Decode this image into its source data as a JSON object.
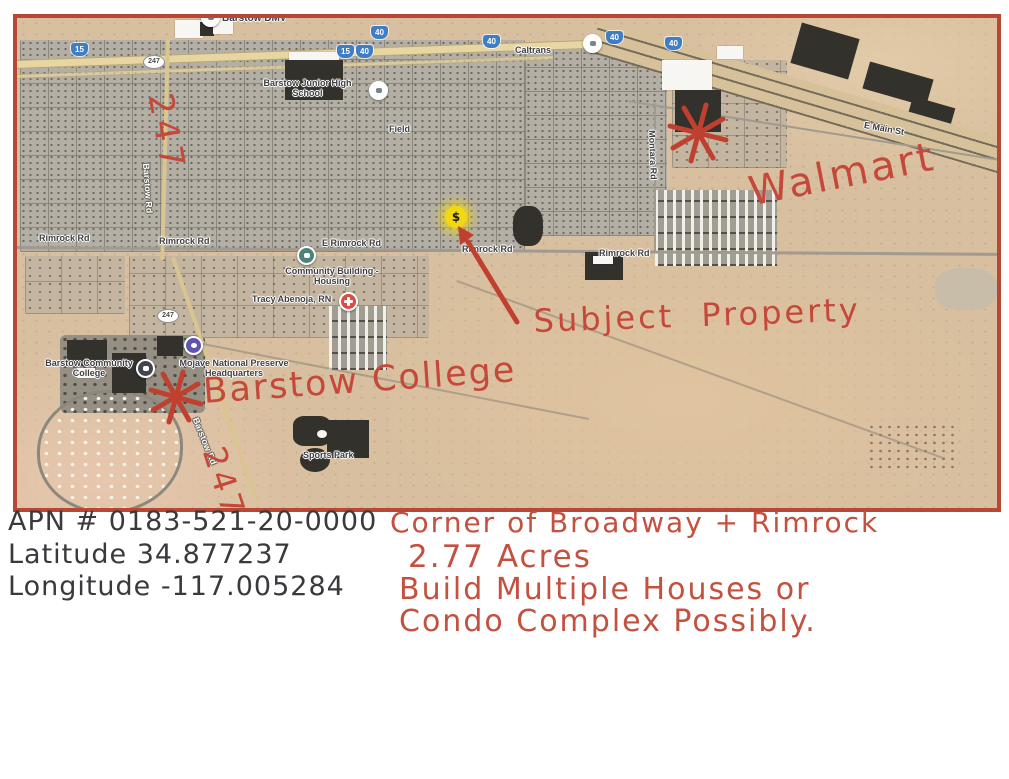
{
  "colors": {
    "map_border": "#b84733",
    "desert": "#d8bf9f",
    "ink_red": "#c4493a",
    "ink_black": "#3a3a3e",
    "marker_yellow": "#f2d713",
    "interstate_blue": "#3f7ec4"
  },
  "map": {
    "poi_labels": {
      "dmv": "Barstow DMV",
      "caltrans": "Caltrans",
      "junior_high": "Barstow Junior High School",
      "field": "Field",
      "community_building": "Community Building - Housing",
      "tracy": "Tracy Abenoja, RN",
      "community_college": "Barstow Community College",
      "mojave_hq": "Mojave National Preserve Headquarters",
      "sports_park": "Sports Park"
    },
    "road_labels": {
      "e_main": "E Main St",
      "montara": "Montara Rd",
      "left_fragment": "d",
      "rimrock_w": "Rimrock Rd",
      "rimrock_c": "Rimrock Rd",
      "e_rimrock": "E Rimrock Rd",
      "rimrock_e1": "Rimrock Rd",
      "rimrock_e2": "Rimrock Rd",
      "barstow_n": "Barstow Rd",
      "barstow_s": "Barstow Rd"
    },
    "shields": {
      "i15_w": "15",
      "r247_n": "247",
      "i40_a": "40",
      "i15_c": "15",
      "i40_b": "40",
      "i40_c": "40",
      "i40_d": "40",
      "i40_e": "40",
      "r247_s": "247"
    },
    "marker": {
      "symbol": "$"
    }
  },
  "annotations": {
    "route_n": "247",
    "walmart": "Walmart",
    "subject": "Subject Property",
    "college": "Barstow College",
    "route_s": "247"
  },
  "notes_black": {
    "apn": "APN # 0183-521-20-0000",
    "latitude": "Latitude 34.877237",
    "longitude": "Longitude -117.005284"
  },
  "notes_red": {
    "line1": "Corner of Broadway + Rimrock",
    "line2": "2.77 Acres",
    "line3": "Build Multiple Houses or",
    "line4": "Condo Complex Possibly."
  }
}
